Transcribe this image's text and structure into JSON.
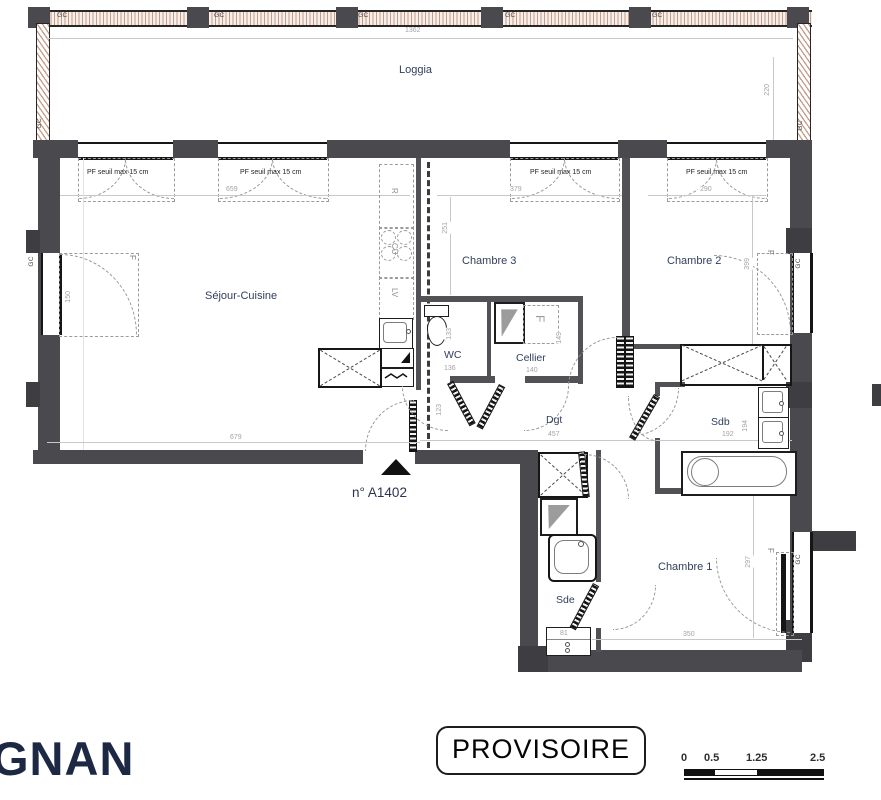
{
  "plan": {
    "unit": "n° A1402",
    "rooms": {
      "loggia": "Loggia",
      "sejour": "Séjour-Cuisine",
      "chambre3": "Chambre 3",
      "chambre2": "Chambre 2",
      "chambre1": "Chambre 1",
      "wc": "WC",
      "cellier": "Cellier",
      "dgt": "Dgt",
      "sdb": "Sdb",
      "sde": "Sde"
    },
    "labels": {
      "gc": "GC",
      "pf": "PF seuil max 15 cm",
      "f": "F",
      "fridge": "R",
      "cooktop": "CU",
      "dishwasher": "LV"
    },
    "dims": {
      "loggia_w": "1362",
      "loggia_d": "220",
      "sejour_top": "659",
      "sejour_bottom": "679",
      "sejour_window": "150",
      "chambre3_w": "379",
      "chambre3_d": "251",
      "chambre2_w": "290",
      "chambre2_d": "399",
      "wc_w": "136",
      "wc_d": "133",
      "cellier_w": "140",
      "cellier_d": "149",
      "dgt_l": "457",
      "entry_d": "123",
      "sdb_w": "192",
      "sdb_d": "194",
      "chambre1_w": "350",
      "chambre1_d": "297",
      "sde_w": "81"
    }
  },
  "footer": {
    "logo": "GNAN",
    "stamp": "PROVISOIRE",
    "scale_ticks": [
      "0",
      "0.5",
      "1.25",
      "2.5"
    ]
  },
  "colors": {
    "wall": "#4a4a4e",
    "room_text": "#31405c",
    "dim_text": "#a3a3a9",
    "hatch": "#c49a89",
    "logo_text": "#1d2845"
  }
}
